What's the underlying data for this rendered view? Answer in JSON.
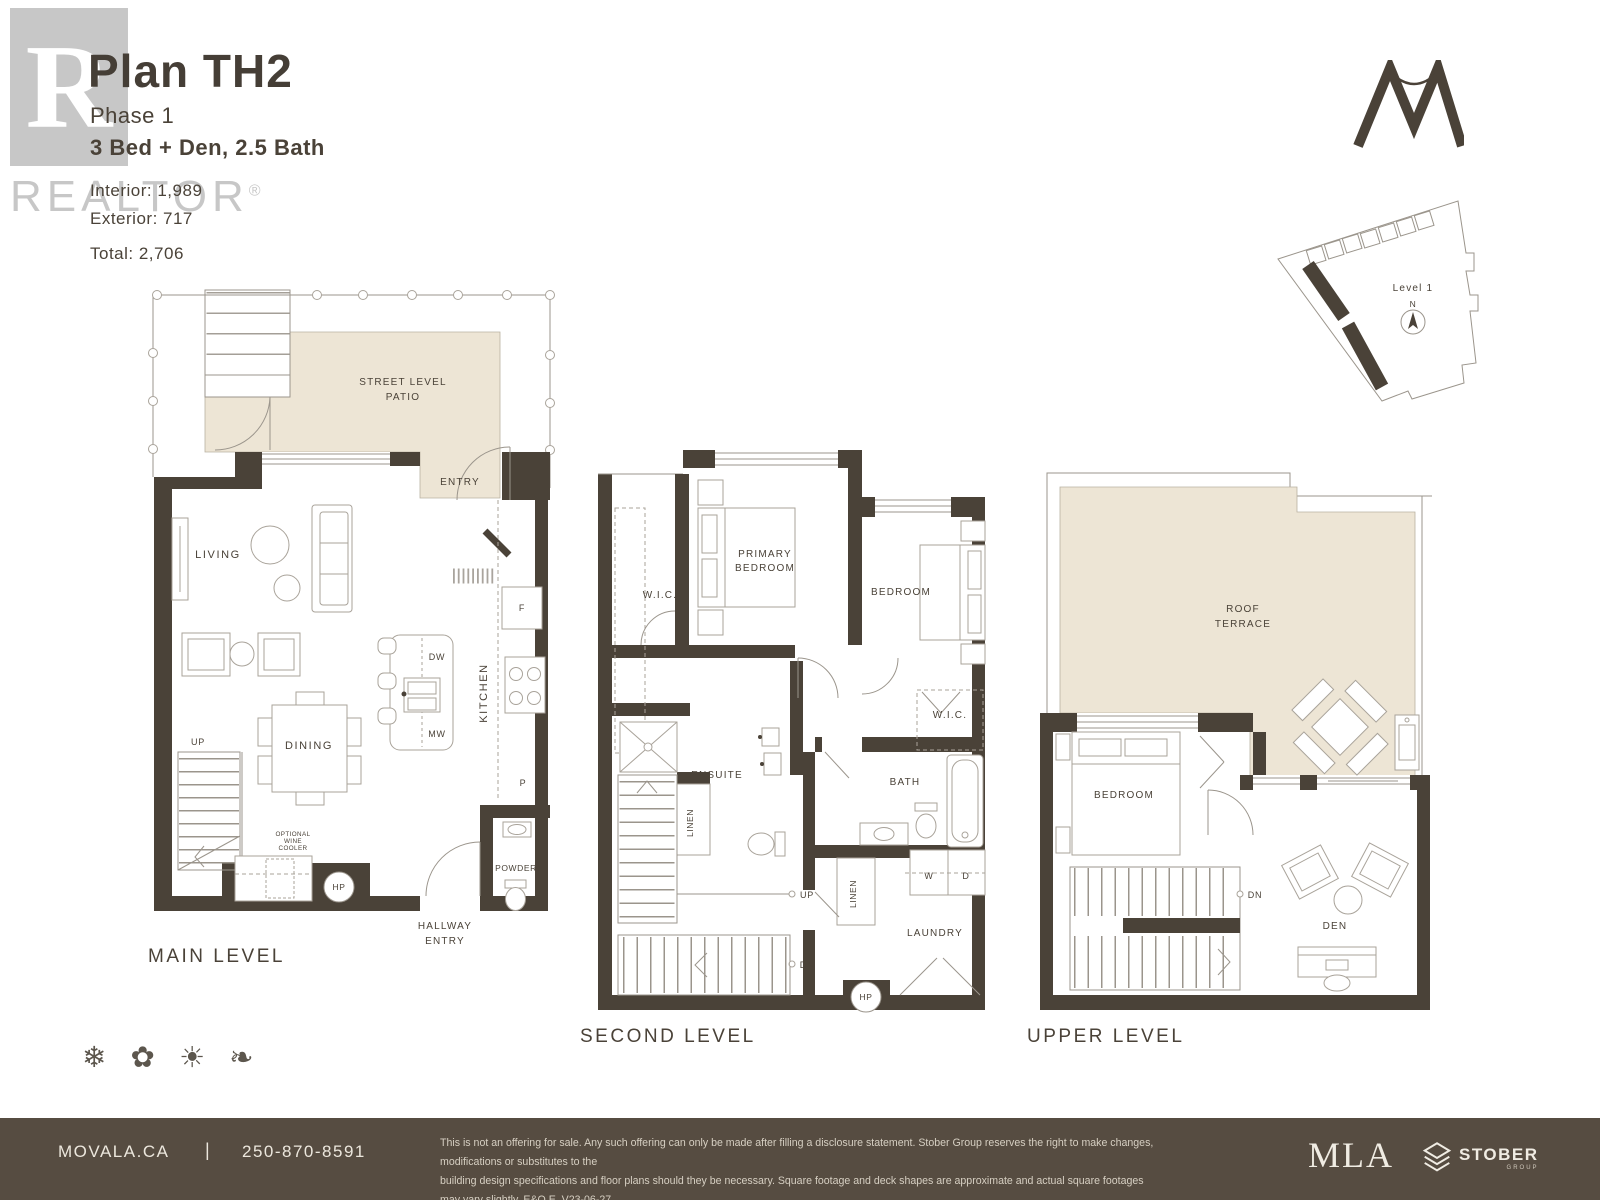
{
  "header": {
    "title": "Plan TH2",
    "phase": "Phase 1",
    "config": "3 Bed + Den, 2.5 Bath",
    "interior": "Interior: 1,989",
    "exterior": "Exterior: 717",
    "total": "Total: 2,706"
  },
  "watermark": {
    "letter": "R",
    "name": "REALTOR",
    "reg": "®"
  },
  "sitemap": {
    "level": "Level 1",
    "north": "N"
  },
  "plans": {
    "main": {
      "name": "MAIN LEVEL",
      "labels": {
        "street1": "STREET LEVEL",
        "street2": "PATIO",
        "entry": "ENTRY",
        "living": "LIVING",
        "dining": "DINING",
        "kitchen": "KITCHEN",
        "up": "UP",
        "dw": "DW",
        "mw": "MW",
        "fridge": "F",
        "pantry": "P",
        "hp": "HP",
        "wine1": "OPTIONAL",
        "wine2": "WINE",
        "wine3": "COOLER",
        "powder": "POWDER",
        "hall1": "HALLWAY",
        "hall2": "ENTRY"
      }
    },
    "second": {
      "name": "SECOND LEVEL",
      "labels": {
        "wic_left": "W.I.C.",
        "primary1": "PRIMARY",
        "primary2": "BEDROOM",
        "bedroom": "BEDROOM",
        "wic_right": "W.I.C.",
        "ensuite": "ENSUITE",
        "linen_left": "LINEN",
        "linen_right": "LINEN",
        "bath": "BATH",
        "washer": "W",
        "dryer": "D",
        "laundry": "LAUNDRY",
        "up": "UP",
        "dn": "DN",
        "hp": "HP"
      }
    },
    "upper": {
      "name": "UPPER LEVEL",
      "labels": {
        "roof1": "ROOF",
        "roof2": "TERRACE",
        "bedroom": "BEDROOM",
        "den": "DEN",
        "dn": "DN"
      }
    }
  },
  "seasons": {
    "winter": "❄",
    "spring": "✿",
    "summer": "☀",
    "autumn": "❧"
  },
  "footer": {
    "website": "MOVALA.CA",
    "separator": "|",
    "phone": "250-870-8591",
    "disclaimer1": "This is not an offering for sale. Any such offering can only be made after filling a disclosure statement. Stober Group reserves the right to make changes, modifications or substitutes to the",
    "disclaimer2": "building design specifications and floor plans should they be necessary. Square footage and deck shapes are approximate and actual square footages may vary slightly. E&O.E. V23-06-27",
    "mla": "MLA",
    "stober": "STOBER",
    "stober_sub": "GROUP"
  }
}
